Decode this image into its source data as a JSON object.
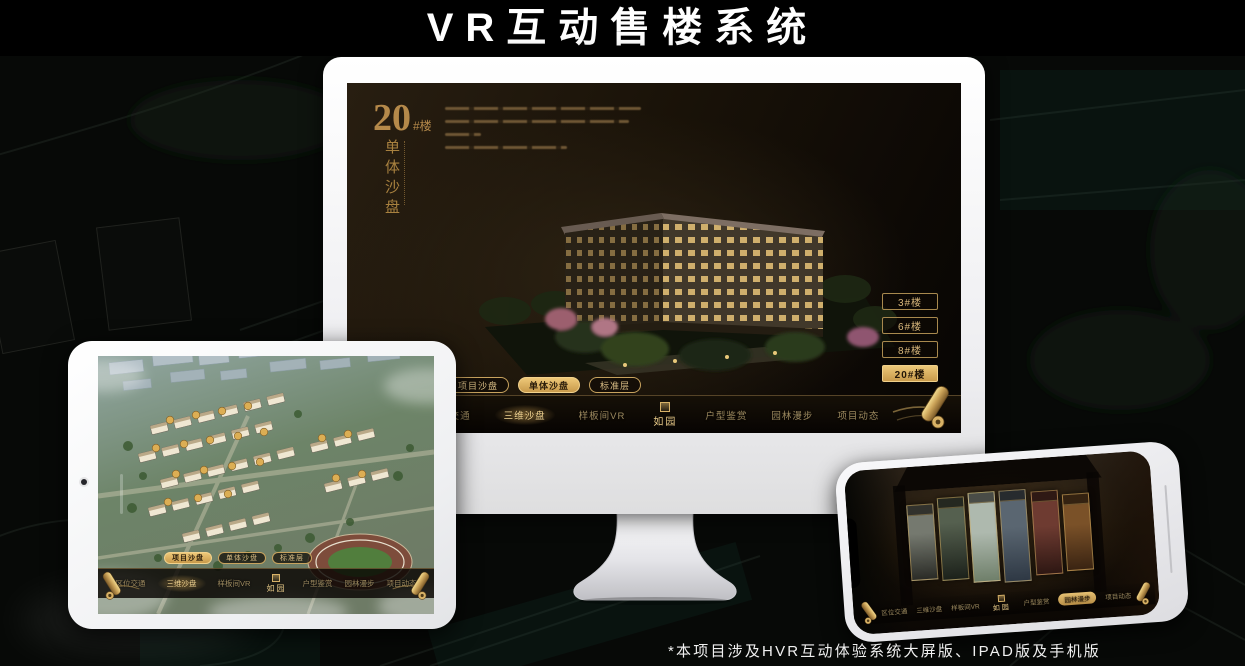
{
  "page": {
    "title": "VR互动售楼系统",
    "footnote": "*本项目涉及HVR互动体验系统大屏版、IPAD版及手机版"
  },
  "sandbox": {
    "heading_number": "20",
    "heading_unit": "#楼",
    "heading_subtitle": "单体沙盘",
    "floor_buttons": [
      "3#楼",
      "6#楼",
      "8#楼",
      "20#楼"
    ],
    "subtabs": [
      "项目沙盘",
      "单体沙盘",
      "标准层"
    ],
    "nav_items": [
      "区位交通",
      "三维沙盘",
      "样板间VR",
      "户型鉴赏",
      "园林漫步",
      "项目动态"
    ],
    "logo": "如园"
  },
  "colors": {
    "gold": "#d4ab66",
    "gold_active": "#ecc878",
    "screen_bg": "#1a1309"
  }
}
